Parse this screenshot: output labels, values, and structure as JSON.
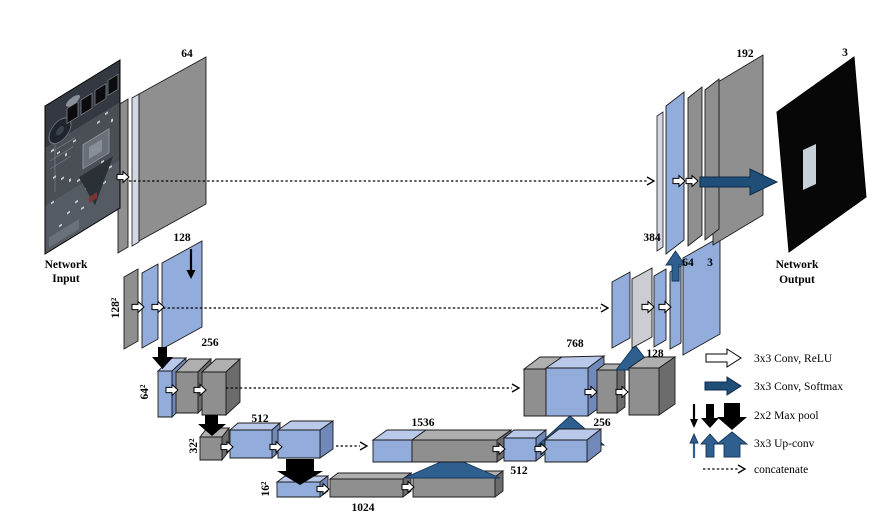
{
  "input": {
    "caption_line1": "Network",
    "caption_line2": "Input"
  },
  "output": {
    "caption_line1": "Network",
    "caption_line2": "Output",
    "channels": "3"
  },
  "encoder": {
    "l1_channels": "64",
    "l2_channels": "128",
    "l2_size": "128²",
    "l3_channels": "256",
    "l3_size": "64²",
    "l4_channels": "512",
    "l4_size": "32²",
    "l5_channels": "1024",
    "l5_size": "16²"
  },
  "decoder": {
    "l4_concat": "1536",
    "l4_out": "512",
    "l4_up": "256",
    "l3_concat": "768",
    "l3_up": "128",
    "l2_concat": "384",
    "l2_out": "64",
    "l2_aux": "3",
    "l1_concat": "192"
  },
  "legend": {
    "conv_relu": "3x3 Conv, ReLU",
    "conv_softmax": "3x3 Conv, Softmax",
    "max_pool": "2x2 Max pool",
    "up_conv": "3x3 Up-conv",
    "concatenate": "concatenate"
  },
  "colors": {
    "feature_blue": "#92ACDB",
    "feature_blue_top": "#BAC8E9",
    "feature_blue_side": "#7089BA",
    "feature_gray": "#8F8F8F",
    "feature_gray_top": "#AFAFAF",
    "feature_gray_side": "#6C6C6C",
    "concat_light_gray": "#CBCDD2",
    "arrow_conv_relu": "#FFFFFF",
    "arrow_conv_softmax": "#1F4E79",
    "arrow_max_pool": "#000000",
    "arrow_up_conv": "#2E5F8F",
    "output_background": "#070707"
  }
}
